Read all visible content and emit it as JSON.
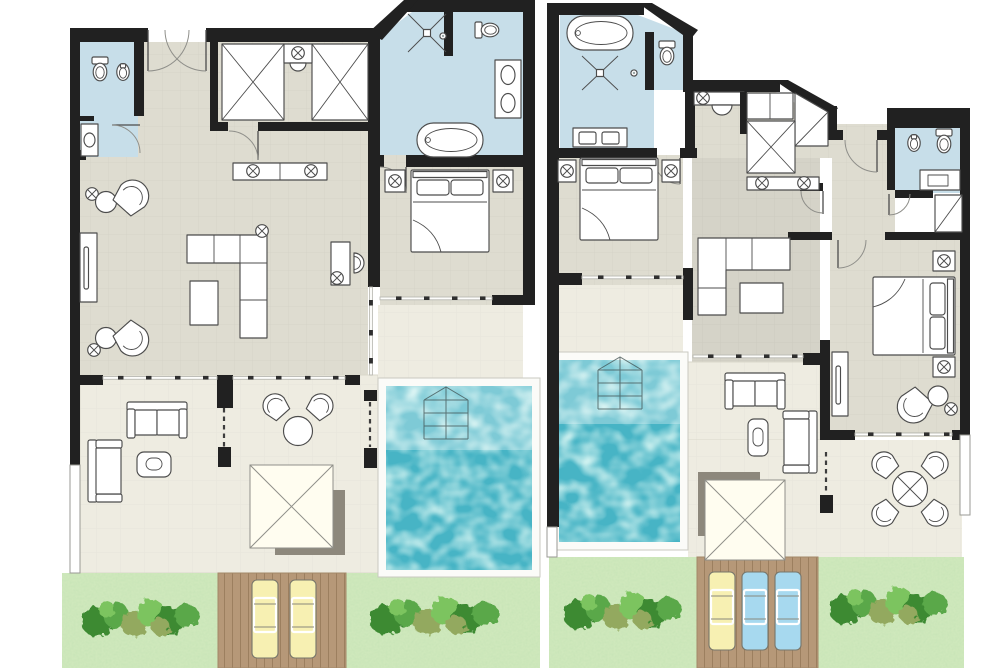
{
  "canvas": {
    "width": 1000,
    "height": 668,
    "background": "#ffffff",
    "description": "Two side-by-side architectural villa floor plans with private pools, covered terraces, sun decks and gardens"
  },
  "palette": {
    "wall": "#212121",
    "floor": "#dedcd0",
    "bath": "#c7dee9",
    "terrace": "#eeece1",
    "pool": "#47b4c5",
    "garden": "#cfe8bc",
    "deck": "#b69878",
    "deckline": "#9c7f5f",
    "loungeryellow": "#f7f0b2",
    "loungerblue": "#a7d9ef",
    "umbrella": "#fffdf0",
    "shadow": "#8d887c",
    "line": "#4c4c4c",
    "stepline": "#3f4f4f",
    "bushdark": "#3c8a33",
    "bushmid": "#5aa84a",
    "bushlight": "#7cc45f",
    "busholive": "#93a95e"
  },
  "plans": [
    {
      "name": "villa-plan-left",
      "rooms": [
        "guest-bathroom",
        "entrance",
        "walk-in-closet",
        "master-bathroom",
        "living-room",
        "bedroom",
        "covered-terrace",
        "private-pool",
        "sun-deck",
        "garden"
      ],
      "fixtures": [
        "toilet",
        "bidet",
        "washbasin",
        "shower",
        "bathtub",
        "double-washbasin"
      ],
      "furniture": [
        "wardrobes",
        "vanity",
        "sideboard",
        "tv-console",
        "armchairs",
        "corner-sofa",
        "coffee-table",
        "desk",
        "double-bed",
        "nightstands",
        "outdoor-sofa",
        "lounge-chair",
        "round-table",
        "terrace-chairs",
        "parasol",
        "sun-loungers-yellow-x2",
        "garden-bushes"
      ]
    },
    {
      "name": "villa-plan-right",
      "rooms": [
        "master-bathroom",
        "toilet-niche",
        "walk-in-closet",
        "entrance-hall",
        "guest-bathroom",
        "bedroom-1",
        "living-room",
        "bedroom-2",
        "covered-terrace",
        "private-pool",
        "sun-deck",
        "garden"
      ],
      "fixtures": [
        "bathtub",
        "shower",
        "toilet",
        "double-washbasin",
        "bidet",
        "washbasin"
      ],
      "furniture": [
        "wardrobes",
        "vanity",
        "corner-sofa",
        "coffee-table",
        "double-bed-1",
        "double-bed-2",
        "nightstands",
        "tv-console",
        "armchair",
        "outdoor-sofa",
        "lounge-chair",
        "dining-table",
        "dining-chairs",
        "parasol",
        "sun-lounger-yellow",
        "sun-loungers-blue-x2",
        "garden-bushes"
      ]
    }
  ]
}
